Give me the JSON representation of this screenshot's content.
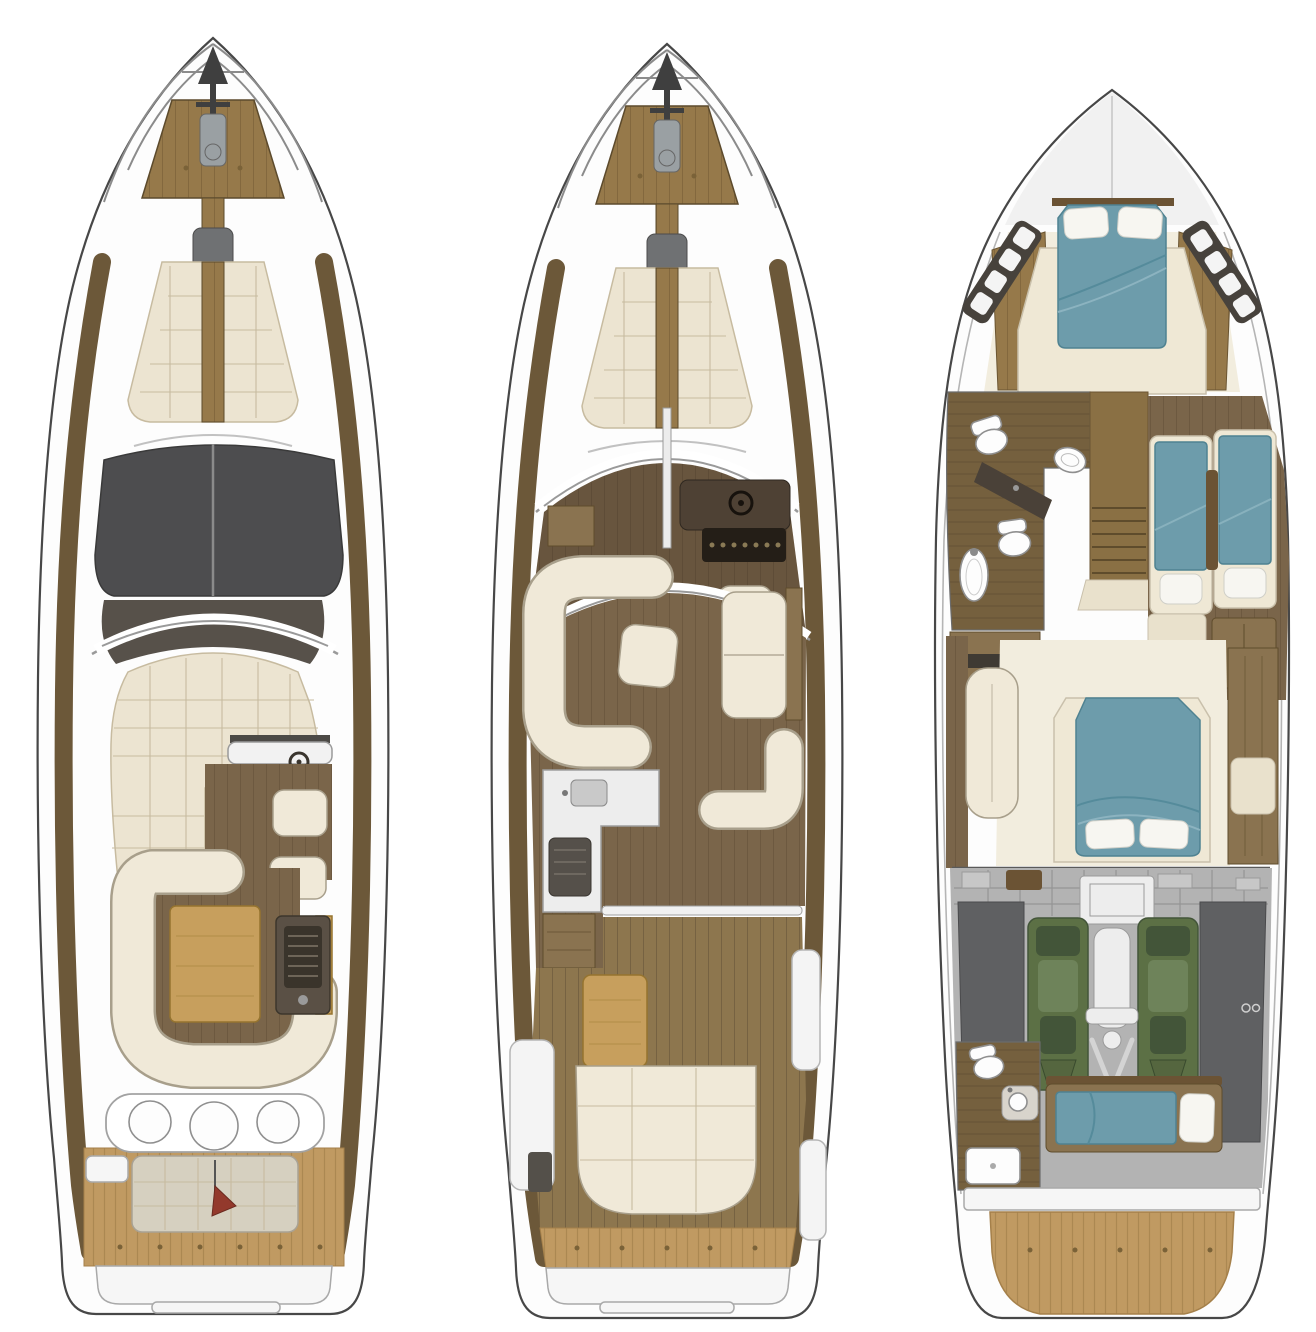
{
  "page": {
    "background": "#ffffff"
  },
  "figure": {
    "type": "yacht-deck-plans",
    "views": [
      {
        "id": "flybridge-deck"
      },
      {
        "id": "main-deck"
      },
      {
        "id": "lower-deck"
      }
    ]
  },
  "colors": {
    "white": "#ffffff",
    "hullLine": "#474747",
    "railGray": "#8b8b8b",
    "anchorDark": "#3f3f3f",
    "windlassGray": "#9aa0a3",
    "consolePadGray": "#6f7173",
    "teakLight": "#c09a62",
    "teakGrain": "#a07d49",
    "foredeckWood": "#96794a",
    "walkwayWood": "#6c5839",
    "sunpadCream": "#ece4d1",
    "sunpadSeam": "#c7bba0",
    "hardtopDark": "#4d4d4f",
    "tintDark": "#57514a",
    "tableWood": "#c79f5d",
    "floorWood": "#7a654a",
    "floorWoodLight": "#8d764e",
    "plankLine": "#5f4e35",
    "sofaCream": "#f0e9d8",
    "sofaOutline": "#a89f8b",
    "dashBrown": "#4e4134",
    "dashSlat": "#241e17",
    "bedTeal": "#6d9cab",
    "bedTealEdge": "#4f8291",
    "bedFoldDark": "#558b9b",
    "bedFoldLight": "#8fb6c2",
    "bedFrameCream": "#efe8d5",
    "pillowWhite": "#f7f6f1",
    "windowPanelDark": "#47423c",
    "bathFloorWood": "#75603e",
    "fixtureWhite": "#fdfdfd",
    "fixtureOutline": "#8f8f8f",
    "vanityDark": "#4a4138",
    "stairsWood": "#8a7044",
    "stairTread": "#5f4c2c",
    "landingCream": "#e9e1cc",
    "masterFloor": "#f2edde",
    "cabinetWood": "#8a7350",
    "woodDarkTrim": "#6b5334",
    "engRoomGray": "#b3b3b3",
    "engRoomLine": "#8f8f8f",
    "engPanelLight": "#c7c7c7",
    "shieldGray": "#5f6062",
    "engineGreen": "#5c7045",
    "engineGreenDark": "#435539",
    "engineGreenLight": "#6e835a",
    "gearWhite": "#ededed",
    "pennantRed": "#93392c",
    "platformWhite": "#f6f6f6",
    "platformOutline": "#a9a9a9",
    "galleyWhite": "#ededed",
    "applianceDark": "#55504a"
  }
}
